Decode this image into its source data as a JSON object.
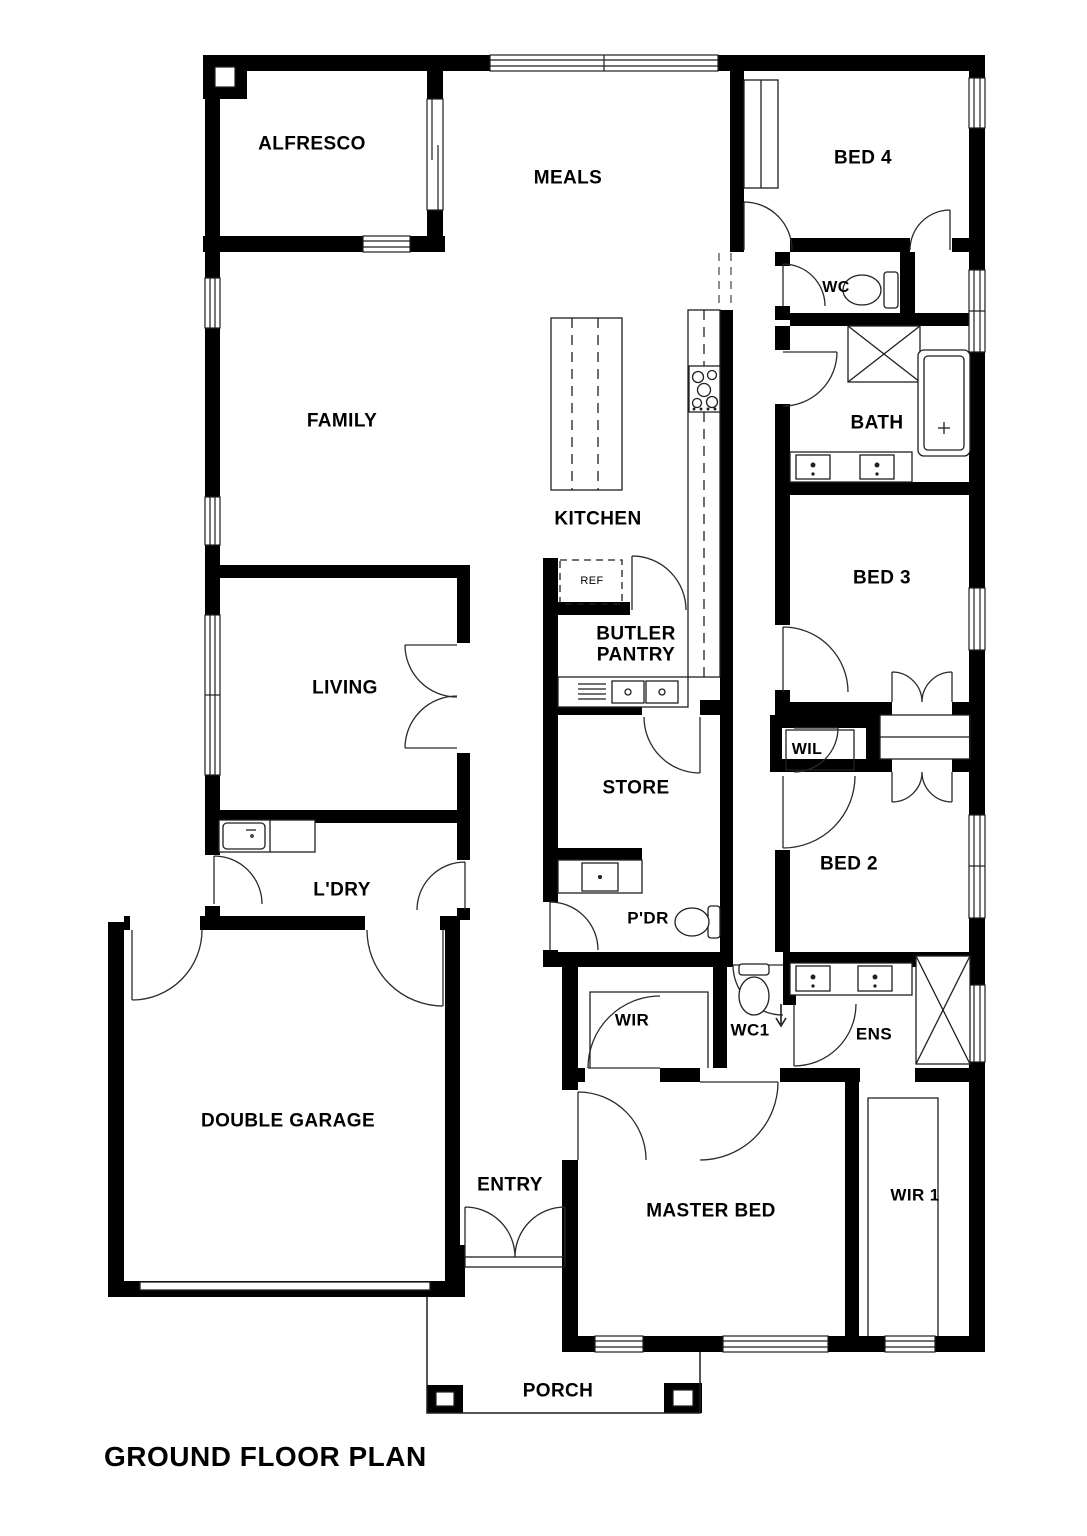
{
  "title": {
    "text": "GROUND FLOOR PLAN"
  },
  "colors": {
    "wall": "#000000",
    "background": "#ffffff",
    "line": "#1f1f1f"
  },
  "labels": [
    {
      "id": "alfresco",
      "text": "ALFRESCO",
      "x": 312,
      "y": 144,
      "size": 19
    },
    {
      "id": "meals",
      "text": "MEALS",
      "x": 568,
      "y": 178,
      "size": 19
    },
    {
      "id": "bed4",
      "text": "BED 4",
      "x": 863,
      "y": 158,
      "size": 19
    },
    {
      "id": "wc",
      "text": "WC",
      "x": 836,
      "y": 288,
      "size": 16
    },
    {
      "id": "family",
      "text": "FAMILY",
      "x": 342,
      "y": 421,
      "size": 19
    },
    {
      "id": "bath",
      "text": "BATH",
      "x": 877,
      "y": 423,
      "size": 19
    },
    {
      "id": "kitchen",
      "text": "KITCHEN",
      "x": 598,
      "y": 519,
      "size": 19
    },
    {
      "id": "bed3",
      "text": "BED 3",
      "x": 882,
      "y": 578,
      "size": 19
    },
    {
      "id": "ref",
      "text": "REF",
      "x": 592,
      "y": 581,
      "size": 11,
      "weight": 400
    },
    {
      "id": "butler-pantry",
      "text": "BUTLER\nPANTRY",
      "x": 636,
      "y": 645,
      "size": 19
    },
    {
      "id": "living",
      "text": "LIVING",
      "x": 345,
      "y": 688,
      "size": 19
    },
    {
      "id": "wil",
      "text": "WIL",
      "x": 807,
      "y": 750,
      "size": 16
    },
    {
      "id": "store",
      "text": "STORE",
      "x": 636,
      "y": 788,
      "size": 19
    },
    {
      "id": "bed2",
      "text": "BED 2",
      "x": 849,
      "y": 864,
      "size": 19
    },
    {
      "id": "ldry",
      "text": "L'DRY",
      "x": 342,
      "y": 890,
      "size": 19
    },
    {
      "id": "pdr",
      "text": "P'DR",
      "x": 648,
      "y": 918,
      "size": 17
    },
    {
      "id": "wir",
      "text": "WIR",
      "x": 632,
      "y": 1020,
      "size": 17
    },
    {
      "id": "wc1",
      "text": "WC1",
      "x": 750,
      "y": 1030,
      "size": 17
    },
    {
      "id": "ens",
      "text": "ENS",
      "x": 874,
      "y": 1034,
      "size": 17
    },
    {
      "id": "double-garage",
      "text": "DOUBLE GARAGE",
      "x": 288,
      "y": 1121,
      "size": 19
    },
    {
      "id": "entry",
      "text": "ENTRY",
      "x": 510,
      "y": 1185,
      "size": 19
    },
    {
      "id": "master-bed",
      "text": "MASTER BED",
      "x": 711,
      "y": 1211,
      "size": 19
    },
    {
      "id": "wir1",
      "text": "WIR 1",
      "x": 915,
      "y": 1195,
      "size": 17
    },
    {
      "id": "porch",
      "text": "PORCH",
      "x": 558,
      "y": 1391,
      "size": 19
    }
  ]
}
